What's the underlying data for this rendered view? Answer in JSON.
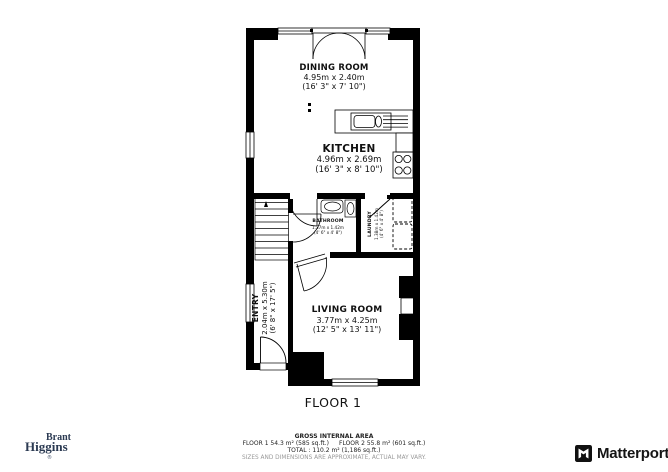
{
  "floor_plan": {
    "floor_label": "FLOOR 1",
    "rooms": {
      "dining": {
        "name": "DINING ROOM",
        "metric": "4.95m x 2.40m",
        "imperial": "(16' 3\" x 7' 10\")"
      },
      "kitchen": {
        "name": "KITCHEN",
        "metric": "4.96m x 2.69m",
        "imperial": "(16' 3\" x 8' 10\")"
      },
      "bathroom": {
        "name": "BATHROOM",
        "metric": "1.37m x 1.42m",
        "imperial": "(4' 6\" x 4' 8\")"
      },
      "laundry": {
        "name": "LAUNDRY",
        "metric": "1.38m x 1.42m",
        "imperial": "(4' 6\" x 4' 8\")"
      },
      "entry": {
        "name": "ENTRY",
        "metric": "2.04m x 5.30m",
        "imperial": "(6' 8\" x 17' 5\")"
      },
      "living": {
        "name": "LIVING ROOM",
        "metric": "3.77m x 4.25m",
        "imperial": "(12' 5\" x 13' 11\")"
      }
    }
  },
  "footer": {
    "area_title": "GROSS INTERNAL AREA",
    "floor1": "FLOOR 1 54.3 m² (585 sq.ft.)",
    "floor2": "FLOOR 2 55.8 m² (601 sq.ft.)",
    "total": "TOTAL : 110.2 m² (1,186 sq.ft.)",
    "disclaimer": "SIZES AND DIMENSIONS ARE APPROXIMATE, ACTUAL MAY VARY."
  },
  "branding": {
    "agency_line1": "Brant",
    "agency_line2": "Higgins",
    "registered": "®",
    "matterport": "Matterport"
  },
  "colors": {
    "wall": "#000000",
    "agency_navy": "#2b3a52",
    "muted_gray": "#9a9a9a"
  }
}
